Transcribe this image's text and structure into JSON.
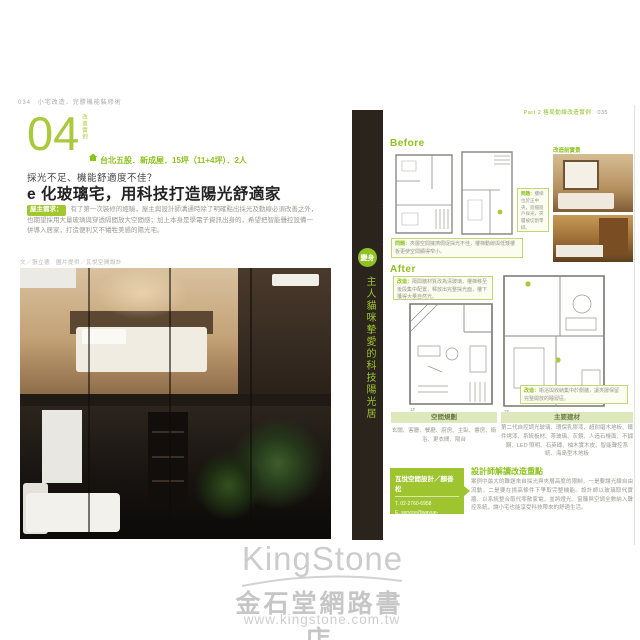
{
  "watermark": {
    "brand": "KingStone",
    "store": "金石堂網路書店",
    "url": "www.kingstone.com.tw"
  },
  "left_page": {
    "page_number": "034",
    "book_title": "小宅改造．完勝機能裝修術",
    "case_number": "04",
    "case_label": "改造實例",
    "case_info": "台北五股．新成屋．15坪（11+4坪）．2人",
    "subtitle": "採光不足、機能舒適度不佳？",
    "title": "e 化玻璃宅，用科技打造陽光舒適家",
    "need_label": "屋主需求：",
    "need_text": "有了第一次裝修的經驗，屋主與設計師溝通時除了明確點出採光及動線必須改善之外，也期望採用大量玻璃與穿透隔間放大空間感；加上本身是學電子資訊出身的，希望把智能聲控設備一併導入居家，打造便利又不犧牲美感的陽光宅。",
    "credit": "文／張立德　圖片提供／瓦悅空間設計"
  },
  "spine": {
    "top_text": "採光與機能舒適度不足",
    "badge": "變身",
    "bottom_text": "主人貓咪摯愛的科技陽光居"
  },
  "right_page": {
    "header": "Part 2 格局動線改造實例",
    "page_number": "035",
    "before": {
      "label": "Before",
      "plan1_label": "1F",
      "plan2_label": "2F",
      "side_note_label": "問題：",
      "side_note_text": "樓梯位於正中央，遮擋窗戶採光，夾層被切割零碎。",
      "bottom_note_label": "問題：",
      "bottom_note_text": "夾層空間擁擠侷促採光不佳，樓梯動線與低矮樓板更使空間顯得窄小。",
      "photos_label": "改造前實景"
    },
    "after": {
      "label": "After",
      "top_note_label": "改造：",
      "top_note_text": "隔間牆材質改為清玻璃，樓梯移至後段集中配置，釋放出完整採光面，樓下獲得大量自然光。",
      "plan1_label": "1F",
      "plan2_label": "2F",
      "bottom_note_label": "改造：",
      "bottom_note_text": "衛浴與收納集中於側牆，讓夾層保留完整開放的睡寢區。"
    },
    "table": {
      "col1_header": "空間規劃",
      "col1_text": "玄關、客廳、餐廳、廚房、主臥、書房、衛浴、更衣間、陽台",
      "col2_header": "主要建材",
      "col2_text": "第二代自控調光玻璃、環保乳膠漆、超耐磨木地板、鐵件烤漆、系統板材、茶玻璃、灰鏡、人造石檯面、不鏽鋼、LED 照明、石英磚、柚木實木皮、智能聲控系統、海島型木地板"
    },
    "designer": {
      "firm": "瓦悅空間設計／顏善松",
      "phone": "T. 02-2760-6958",
      "email": "E. service@wayue-design.com",
      "website": "www.wayue-design.com",
      "notes_title": "設計師解讀改造重點",
      "notes_text": "案例中最大的難題來自採光與夾層高度的限制，一是要讓光線自由流動，二是要在挑高條件下爭取完整機能。設計師以玻璃取代實牆、以系統整合取代零散家電，並將燈光、窗簾與空調全數納入聲控系統，讓小宅也能享受科技帶來的舒適生活。"
    }
  },
  "colors": {
    "accent": "#8dc21f",
    "accent_light": "#aac93c",
    "spine_bg": "#2b241d",
    "note_bg": "#fcfdf1",
    "note_border": "#c3d677",
    "table_header_bg": "#dde9bd",
    "watermark_gray": "#c9c9c9"
  }
}
